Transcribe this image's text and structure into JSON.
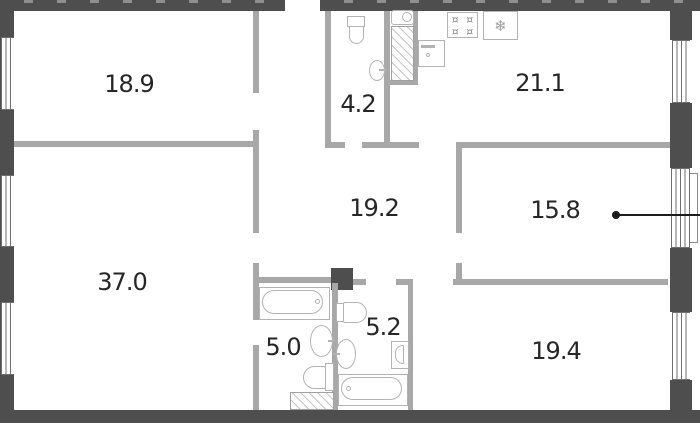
{
  "plan_title": "apartment-floor-plan",
  "rooms": [
    {
      "name": "bedroom-top-left",
      "area_label": "18.9"
    },
    {
      "name": "bathroom-top",
      "area_label": "4.2"
    },
    {
      "name": "kitchen-living-room",
      "area_label": "21.1"
    },
    {
      "name": "hallway",
      "area_label": "19.2"
    },
    {
      "name": "bedroom-right",
      "area_label": "15.8"
    },
    {
      "name": "room-bottom-left",
      "area_label": "37.0"
    },
    {
      "name": "bathroom-bottom-left",
      "area_label": "5.0"
    },
    {
      "name": "bathroom-bottom-right",
      "area_label": "5.2"
    },
    {
      "name": "bedroom-bottom-right",
      "area_label": "19.4"
    }
  ],
  "callout": {
    "attached_room_area": "15.8",
    "style": "dot-with-line-to-right-edge"
  },
  "icons": {
    "refrigerator_glyph": "❄",
    "stove_burner_glyph": "¤"
  },
  "colors": {
    "outer_wall": "#4e4e4e",
    "inner_wall": "#a8a8a8",
    "fixture_outline": "#b3b3b3",
    "hatch_line": "#c6c6c6",
    "label_text": "#262626",
    "callout": "#1c1c1c",
    "background": "#ffffff"
  }
}
